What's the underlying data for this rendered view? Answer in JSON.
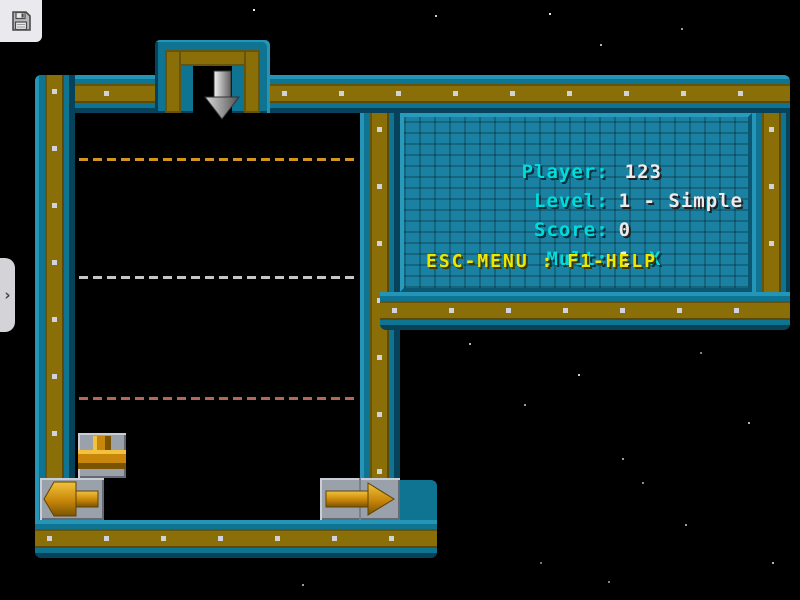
{
  "overlay": {
    "save_icon": "floppy-disk",
    "drawer_chevron": "›"
  },
  "hud": {
    "rows": [
      {
        "label": "Player:",
        "value": "123"
      },
      {
        "label": "Level:",
        "value": "1 - Simple"
      },
      {
        "label": "Score:",
        "value": "0"
      },
      {
        "label": "Mult:",
        "value": "1",
        "suffix": "X"
      }
    ],
    "help": "ESC-MENU : F1-HELP"
  },
  "game": {
    "dash_colors": [
      "#d4951c",
      "#c6c6c6",
      "#b4685c"
    ],
    "pieces": [
      "tee-up",
      "arrow-left",
      "arrow-right",
      "drop-arrow"
    ]
  },
  "colors": {
    "frame_teal": "#0f7392",
    "frame_teal_light": "#2495b6",
    "frame_olive": "#8a6f08",
    "panel_brick": "#1b81a2",
    "label_cyan": "#00dcdc",
    "value_white": "#eceaea",
    "help_yellow": "#ece800",
    "pipe_gold": "#c8860a",
    "rivet_gray": "#d0d4da"
  },
  "stars": [
    [
      253,
      9,
      0.95
    ],
    [
      435,
      15,
      0.8
    ],
    [
      549,
      13,
      0.9
    ],
    [
      600,
      44,
      0.7
    ],
    [
      681,
      28,
      0.6
    ],
    [
      308,
      84,
      0.8
    ],
    [
      237,
      104,
      0.55
    ],
    [
      115,
      168,
      0.5
    ],
    [
      146,
      344,
      0.6
    ],
    [
      232,
      350,
      0.5
    ],
    [
      262,
      208,
      0.4
    ],
    [
      331,
      262,
      0.45
    ],
    [
      469,
      343,
      0.7
    ],
    [
      524,
      404,
      0.6
    ],
    [
      578,
      374,
      0.8
    ],
    [
      622,
      458,
      0.6
    ],
    [
      700,
      352,
      0.5
    ],
    [
      748,
      422,
      0.7
    ],
    [
      642,
      482,
      0.55
    ],
    [
      685,
      524,
      0.6
    ],
    [
      772,
      562,
      0.7
    ],
    [
      608,
      581,
      0.5
    ],
    [
      540,
      562,
      0.45
    ],
    [
      302,
      584,
      0.6
    ]
  ]
}
